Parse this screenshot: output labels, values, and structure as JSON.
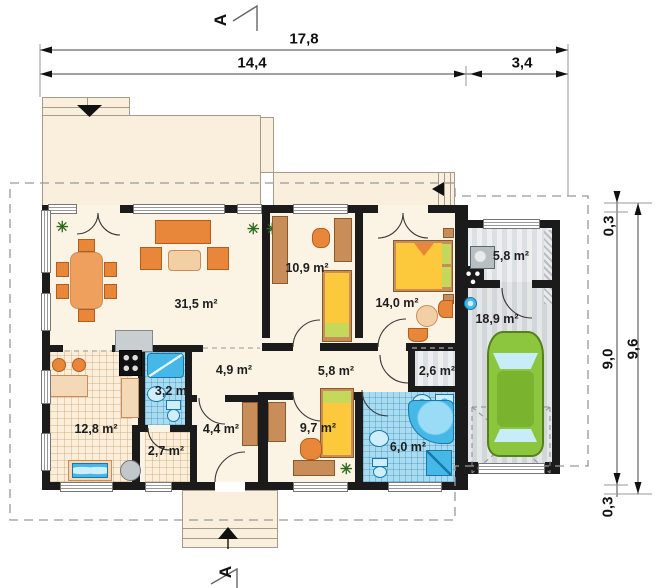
{
  "section_markers": {
    "top": "A",
    "bottom": "A"
  },
  "dimensions": {
    "total_width": "17,8",
    "house_width": "14,4",
    "garage_width": "3,4",
    "overhang_top": "0,3",
    "house_depth": "9,0",
    "total_depth": "9,6",
    "overhang_bottom": "0,3"
  },
  "rooms": [
    {
      "id": "living-room",
      "area": "31,5 m²"
    },
    {
      "id": "bedroom-small",
      "area": "10,9 m²"
    },
    {
      "id": "bedroom-double",
      "area": "14,0 m²"
    },
    {
      "id": "boiler-room",
      "area": "5,8 m²"
    },
    {
      "id": "garage",
      "area": "18,9 m²"
    },
    {
      "id": "hall",
      "area": "4,9 m²"
    },
    {
      "id": "corridor",
      "area": "5,8 m²"
    },
    {
      "id": "laundry",
      "area": "2,6 m²"
    },
    {
      "id": "bathroom-small",
      "area": "3,2 m²"
    },
    {
      "id": "kitchen",
      "area": "12,8 m²"
    },
    {
      "id": "entry",
      "area": "2,7 m²"
    },
    {
      "id": "wardrobe-room",
      "area": "4,4 m²"
    },
    {
      "id": "bedroom-child",
      "area": "9,7 m²"
    },
    {
      "id": "bathroom-main",
      "area": "6,0 m²"
    }
  ],
  "icons": {
    "plant_glyph": "✳"
  },
  "colors": {
    "wall": "#1b1b1b",
    "floor": "#fbf3e3",
    "terrace": "#f9efdc",
    "furniture_orange": "#e8873a",
    "wood": "#c98d5a",
    "bath_tile": "#aadcf1",
    "fixture_blue": "#45b8e8",
    "garage_floor": "#d9dcdd",
    "car_green": "#8cc63e",
    "bed_yellow": "#fcc93d",
    "pillow_green": "#c4d85b"
  }
}
